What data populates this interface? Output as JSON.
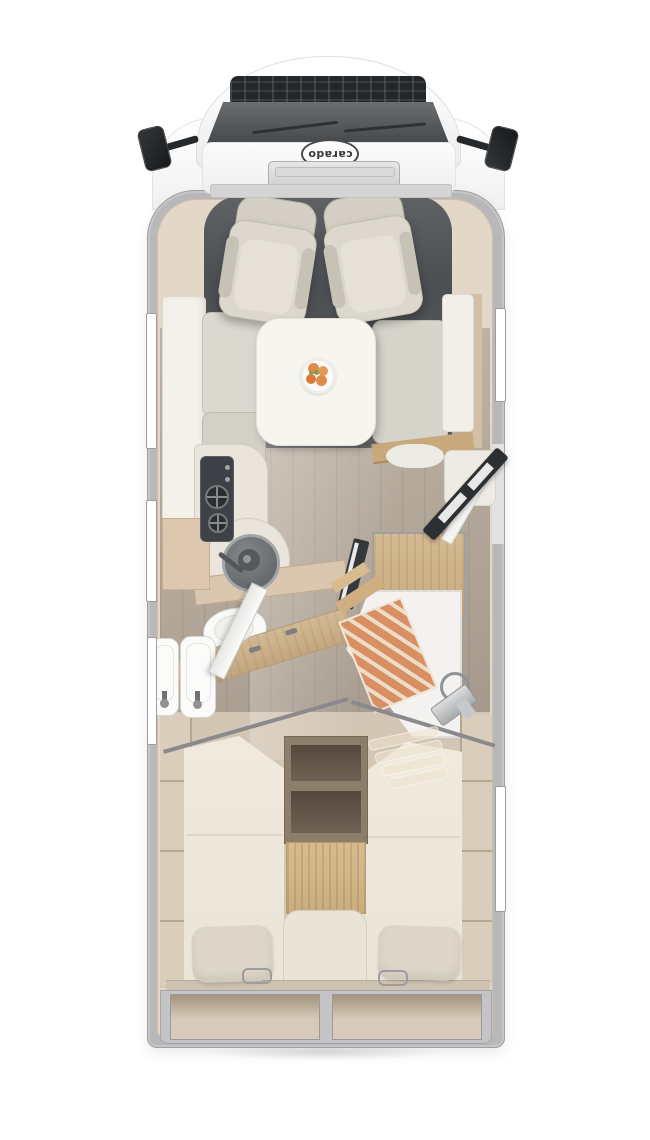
{
  "brand": {
    "logo_text": "carado"
  },
  "colors": {
    "shell_gray": "#b8b8ba",
    "interior_beige": "#e3d7c7",
    "floor_wood": "#b5a99b",
    "cab_floor": "#4c4f52",
    "panel_white": "#f3f1ea",
    "cushion": "#d6d3ca",
    "table_white": "#f7f5ef",
    "counter": "#e9e5dc",
    "dark_fixture": "#3e4246",
    "wood_cabinet": "#d4ba92",
    "shower_mat": "#d88f61",
    "door_dark": "#2d3033",
    "bed": "#ebe5d8",
    "pillow": "#ded7c9",
    "step_wood": "#d7bc90",
    "storage": "#d8caba",
    "fruit_orange": "#e08a4a",
    "window_white": "#ffffff"
  }
}
